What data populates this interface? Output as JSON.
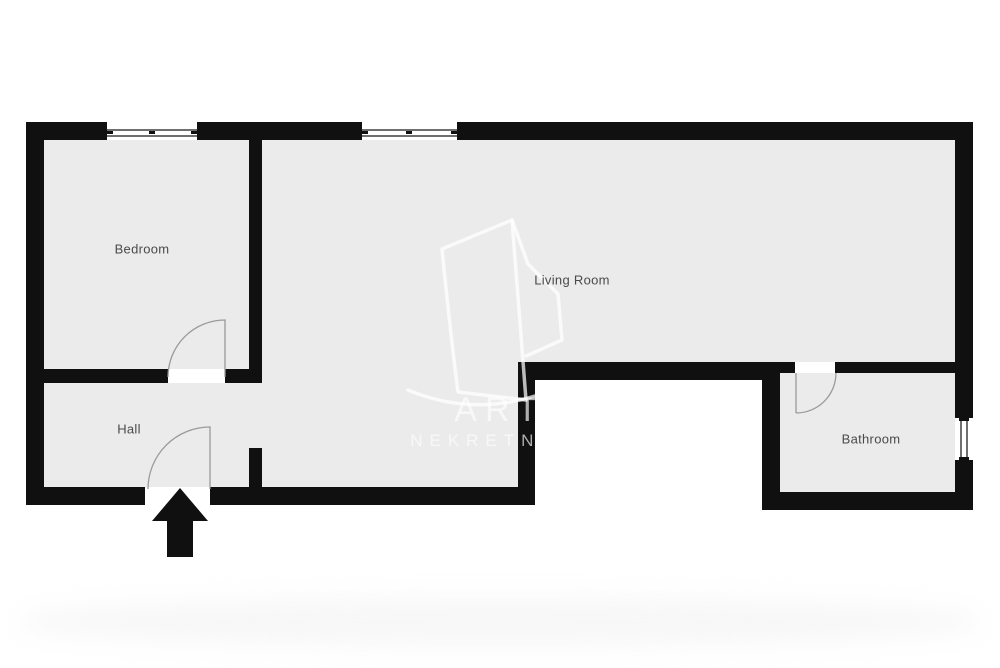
{
  "rooms": {
    "bedroom": {
      "label": "Bedroom"
    },
    "hall": {
      "label": "Hall"
    },
    "living_room": {
      "label": "Living Room"
    },
    "bathroom": {
      "label": "Bathroom"
    }
  },
  "watermark": {
    "brand_top": "ART",
    "brand_bottom": "NEKRETNINE"
  },
  "icons": {
    "entrance_arrow": "up-arrow",
    "logo": "building-outline"
  },
  "colors": {
    "wall": "#101010",
    "floor": "#ebebeb",
    "background": "#ffffff",
    "room_label": "#4a4a4a",
    "door_swing": "#9a9a9a",
    "watermark": "rgba(255,255,255,0.66)"
  }
}
